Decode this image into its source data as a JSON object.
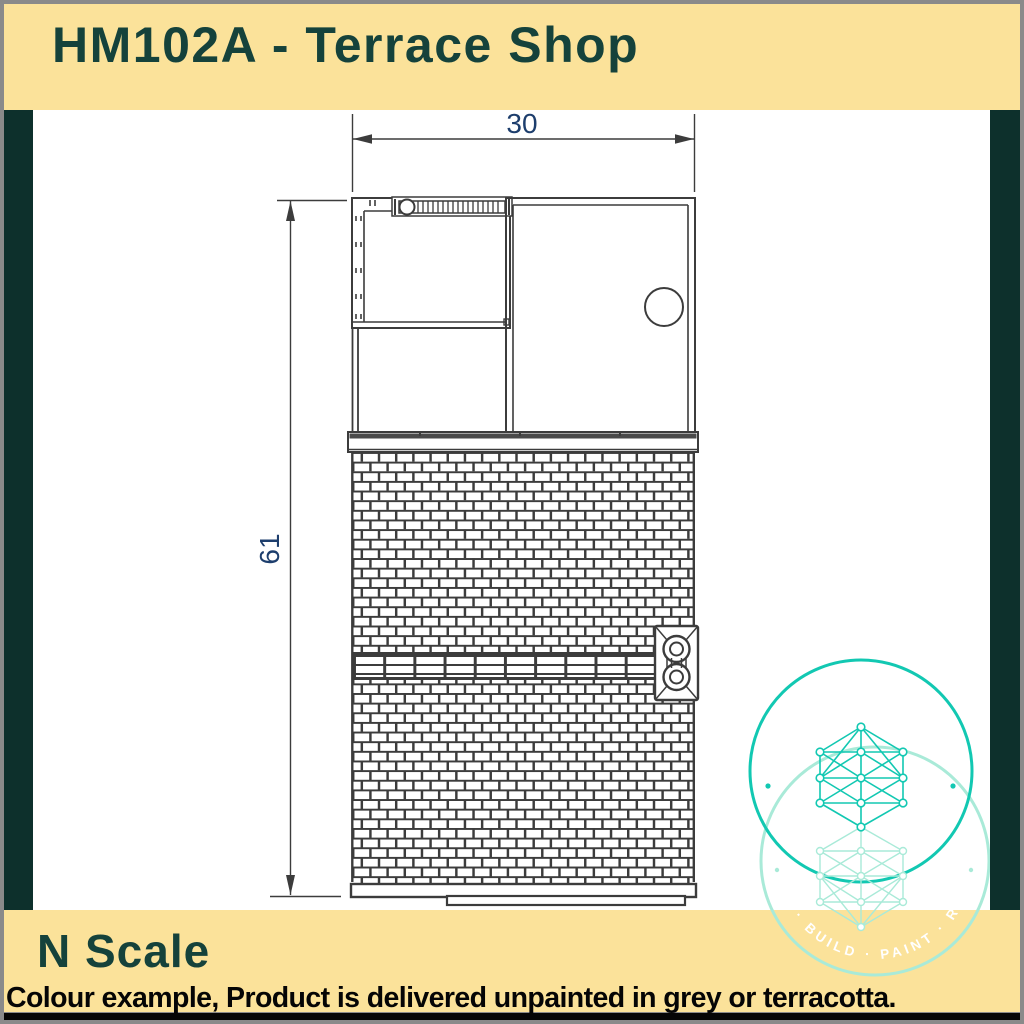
{
  "header": {
    "title": "HM102A - Terrace Shop"
  },
  "footer": {
    "scale_label": "N Scale",
    "note": "Colour example, Product is delivered unpainted in grey or terracotta."
  },
  "drawing": {
    "type": "technical-plan-and-elevation",
    "subject": "terrace shop model kit part, roof plan above brick wall elevation",
    "width_dimension_label": "30",
    "height_dimension_label": "61",
    "features": [
      "roof plan with ridge detail and chimney pot circle",
      "eaves gutter band",
      "brick elevation in running bond",
      "stone string course band",
      "twin-circle vent plaque",
      "base sill bars"
    ]
  },
  "watermark": {
    "icon": "network-lattice-logo",
    "motto_visible": "NT · BUILD · PAINT · REP"
  },
  "colors": {
    "banner_yellow": "#fbe29a",
    "side_bar_green": "#0d302c",
    "title_teal": "#15423b",
    "dimension_blue": "#1d3e6d",
    "line_dark": "#3c3c3c",
    "teal_bright": "#12c8b2",
    "teal_light": "#a9ead8",
    "note_black": "#050505",
    "frame_grey": "#8a8a8a"
  }
}
